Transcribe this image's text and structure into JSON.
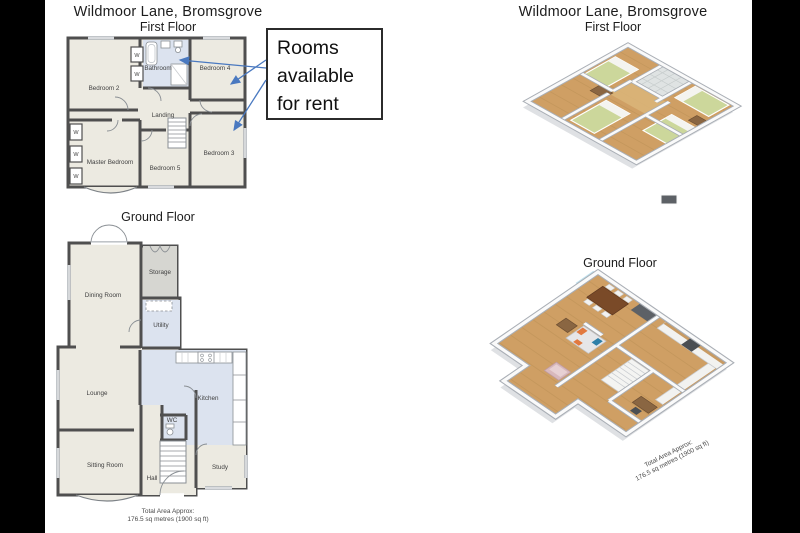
{
  "colors": {
    "background": "#000000",
    "canvas": "#ffffff",
    "wall": "#4f4f4f",
    "room_beige": "#eceae1",
    "room_blue": "#dce3ef",
    "room_gray": "#d6d6d1",
    "annotation_blue": "#4a79c0",
    "wood_floor": "#c99e63",
    "wood_floor_light": "#d9b67f",
    "bed_green": "#ccd79b",
    "slab_gray": "#e2e4e7"
  },
  "left_plan": {
    "title": "Wildmoor Lane, Bromsgrove",
    "floor_label": "First Floor",
    "first_floor_rooms": {
      "bedroom2": "Bedroom 2",
      "bathroom": "Bathroom",
      "bedroom4": "Bedroom 4",
      "landing": "Landing",
      "master_bedroom": "Master Bedroom",
      "bedroom5": "Bedroom 5",
      "bedroom3": "Bedroom 3"
    },
    "wardrobe": "W",
    "ground_floor_label": "Ground Floor",
    "ground_floor_rooms": {
      "dining": "Dining Room",
      "storage": "Storage",
      "utility": "Utility",
      "lounge": "Lounge",
      "kitchen": "Kitchen",
      "wc": "WC",
      "hall": "Hall",
      "study": "Study",
      "sitting": "Sitting Room"
    },
    "total_area_line1": "Total Area Approx:",
    "total_area_line2": "176.5 sq metres (1900 sq ft)"
  },
  "annotation": {
    "line1": "Rooms",
    "line2": "available",
    "line3": "for rent"
  },
  "right_plan": {
    "title": "Wildmoor Lane, Bromsgrove",
    "floor_label": "First Floor",
    "ground_floor_label": "Ground Floor",
    "total_area_line1": "Total Area Approx:",
    "total_area_line2": "176.5 sq metres (1900 sq ft)"
  }
}
